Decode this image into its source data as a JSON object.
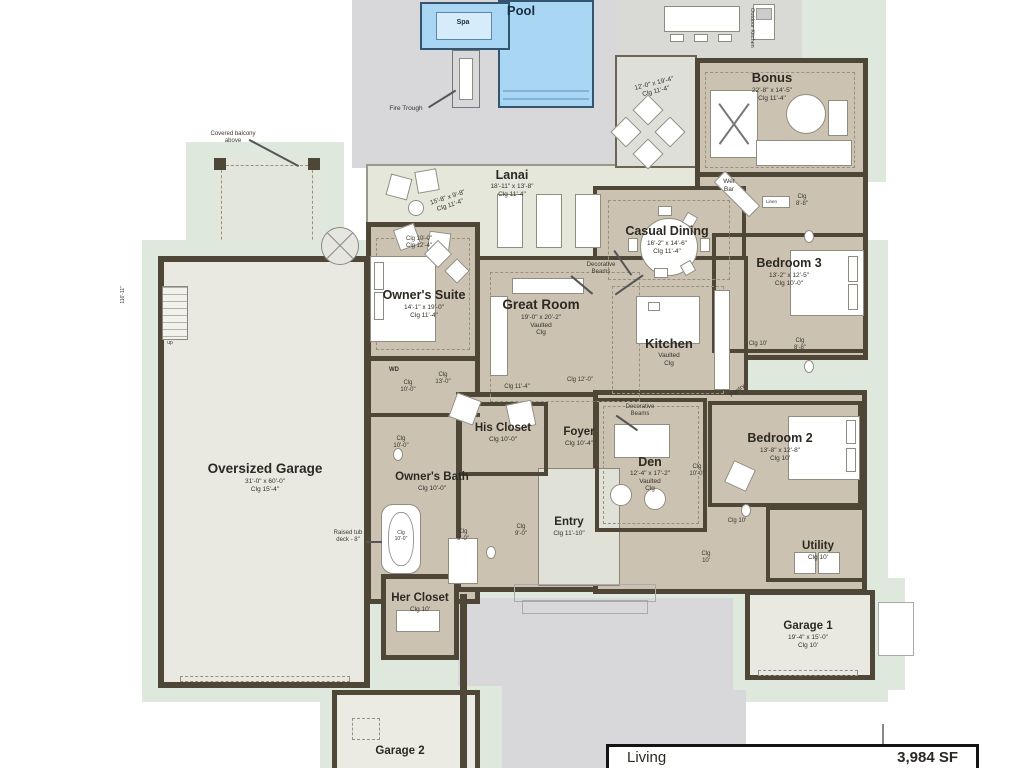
{
  "plan": {
    "colors": {
      "wall": "#4e4737",
      "floor_tan": "#cbc2b2",
      "pool_blue": "#a9d7f3",
      "deck_grey": "#d8d8da",
      "buffer_green": "#dfe8dd",
      "lanai": "#e5e7db"
    },
    "pool": {
      "name": "Pool"
    },
    "spa": {
      "name": "Spa"
    },
    "fire_trough": "Fire Trough",
    "lanai": {
      "name": "Lanai",
      "dims": "18'-11\" x 13'-8\"\nClg 11'-4\""
    },
    "lanai_seating_dims": "15'-8\" x 9'-8\"\nClg 11'-4\"",
    "outdoor_living_dims": "12'-0\" x 19'-4\"\nClg 11'-4\"",
    "outdoor_kitchen": "Outdoor Kitchen",
    "bonus": {
      "name": "Bonus",
      "dims": "22'-8\" x 14'-5\"\nClg 11'-4\""
    },
    "wet_bar": "Wet\nBar",
    "linen": "Linen",
    "bonus_bath_clg": "Clg\n8'-8\"",
    "bed3_bath_clg": "Clg\n8'-8\"",
    "casual_dining": {
      "name": "Casual Dining",
      "dims": "16'-2\" x 14'-6\"\nClg 11'-4\""
    },
    "bedroom3": {
      "name": "Bedroom 3",
      "dims": "13'-2\" x 12'-5\"\nClg 10'-0\""
    },
    "owners_suite": {
      "name": "Owner's Suite",
      "dims": "14'-1\" x 19'-0\"\nClg 11'-4\""
    },
    "owners_clg_note": "Clg 10'-0\"\nClg 12'-4\"",
    "great_room": {
      "name": "Great Room",
      "dims": "19'-0\" x 20'-2\"\nVaulted\nClg"
    },
    "kitchen": {
      "name": "Kitchen",
      "dims": "Vaulted\nClg"
    },
    "decorative_beams": "Decorative\nBeams",
    "pantry": "Pantry",
    "den": {
      "name": "Den",
      "dims": "12'-4\" x 17'-2\"\nVaulted\nClg"
    },
    "bedroom2": {
      "name": "Bedroom 2",
      "dims": "13'-8\" x 12'-8\"\nClg 10'"
    },
    "his_closet": {
      "name": "His Closet",
      "dims": "Clg 10'-0\""
    },
    "foyer": {
      "name": "Foyer",
      "dims": "Clg 10'-4\""
    },
    "owners_bath": {
      "name": "Owner's Bath",
      "dims": "Clg 10'-0\""
    },
    "oversized_garage": {
      "name": "Oversized Garage",
      "dims": "31'-0\" x 60'-0\"\nClg 15'-4\""
    },
    "entry": {
      "name": "Entry",
      "dims": "Clg 11'-10\""
    },
    "her_closet": {
      "name": "Her Closet",
      "dims": "Clg 10'"
    },
    "utility": {
      "name": "Utility",
      "dims": "Clg 10'"
    },
    "garage1": {
      "name": "Garage 1",
      "dims": "19'-4\" x 15'-0\"\nClg 10'"
    },
    "garage2": {
      "name": "Garage 2"
    },
    "wd": "WD",
    "up": "up",
    "balcony_note": "Covered balcony\nabove",
    "tub_note": "Raised tub\ndeck - 8\"",
    "tub_clg": "Clg\n10'-0\"",
    "left_dim": "116'-11\"",
    "clg": {
      "great_s": "Clg 11'-4\"",
      "kitchen_s": "Clg 12'-0\"",
      "hall_bed3": "Clg 10'",
      "hall_den": "Clg\n10'-0\"",
      "hall_bed2": "Clg 10'",
      "hall_utility": "Clg\n10'",
      "wd_hall": "Clg\n10'-0\"",
      "his_hall": "Clg\n13'-0\"",
      "wc1": "Clg\n10'-0\"",
      "shower1": "Clg\n9'-0\"",
      "wc2": "Clg\n9'-0\""
    },
    "area_table": {
      "label": "Living",
      "value": "3,984 SF"
    }
  }
}
